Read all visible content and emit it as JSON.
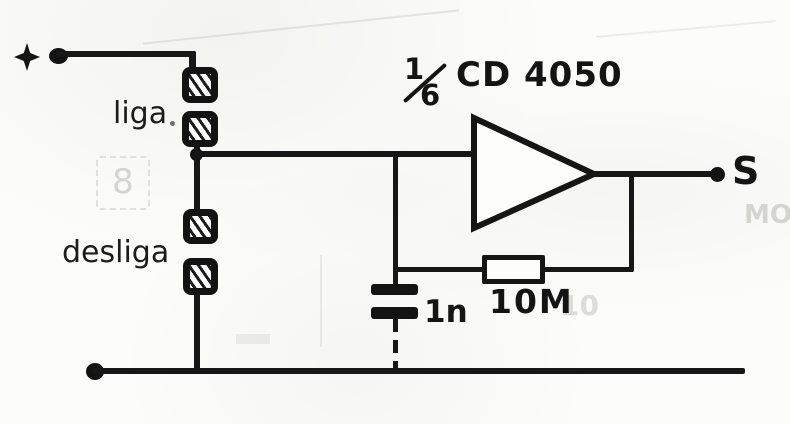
{
  "title": "Touch switch schematic using 1/6 CD 4050 buffer",
  "colors": {
    "ink": "#161616",
    "paper": "#fcfcfa",
    "ghost": "#d5d5d0"
  },
  "labels": {
    "supply_plus": "+",
    "touch_on": "liga",
    "touch_off": "desliga",
    "gate_fraction_numerator": "1",
    "gate_fraction_denominator": "6",
    "ic_name": "CD 4050",
    "feedback_resistor_value": "10M",
    "capacitor_value": "1n",
    "output": "S"
  },
  "artifacts": {
    "bleed_left_box": "8",
    "bleed_right_text": "MO",
    "bleed_near_resistor": "10"
  }
}
